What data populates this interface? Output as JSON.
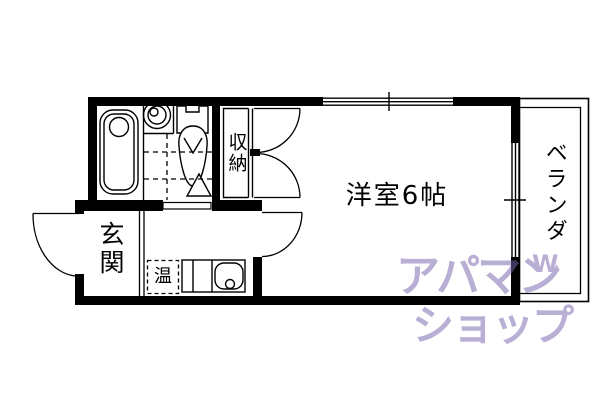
{
  "floorplan": {
    "room_label": "洋室6帖",
    "closet_label": "収納",
    "entrance_label": "玄関",
    "water_heater_label": "温",
    "balcony_label": "ベランダ"
  },
  "watermark": {
    "line1": "アパマン",
    "line2": "ショップ",
    "mark": "W",
    "color": "#7a66ad"
  },
  "colors": {
    "line_color": "#000000",
    "background": "#ffffff"
  }
}
